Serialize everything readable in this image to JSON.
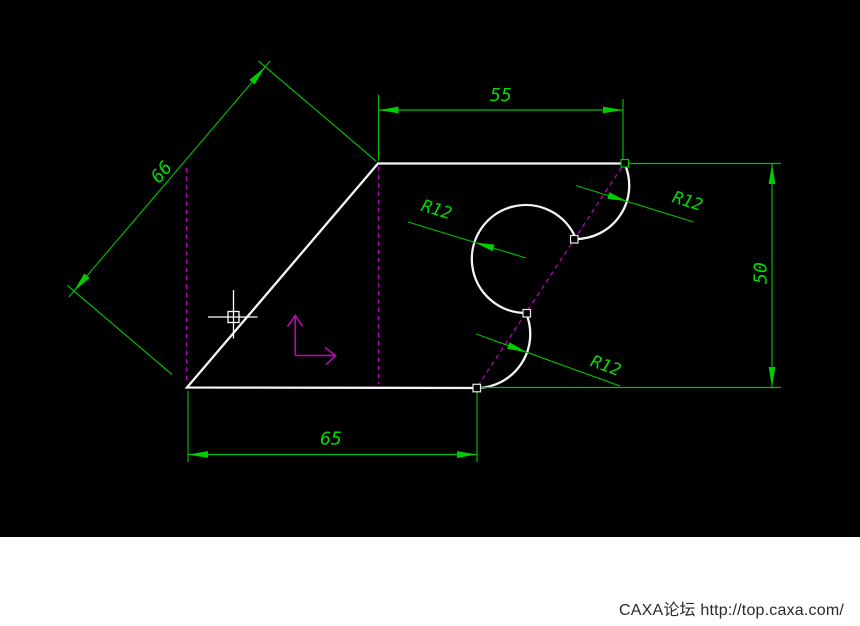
{
  "canvas": {
    "background": "#000000",
    "geometry_color": "#F5F5F5",
    "dimension_color": "#00BE00",
    "dimension_text_color": "#00DC00",
    "centerline_color": "#B800B8",
    "axis_icon_color": "#C800C8",
    "cursor_color": "#FFFFFF"
  },
  "dimensions": {
    "aligned_66": {
      "label": "66",
      "value": 66
    },
    "top_55": {
      "label": "55",
      "value": 55
    },
    "right_50": {
      "label": "50",
      "value": 50
    },
    "bottom_65": {
      "label": "65",
      "value": 65
    },
    "radius_left": {
      "label": "R12",
      "value": 12
    },
    "radius_top": {
      "label": "R12",
      "value": 12
    },
    "radius_bottom": {
      "label": "R12",
      "value": 12
    }
  },
  "footer": {
    "watermark": "CAXA论坛 http://top.caxa.com/",
    "background": "#FFFFFF",
    "text_color": "#2A2A2A"
  }
}
